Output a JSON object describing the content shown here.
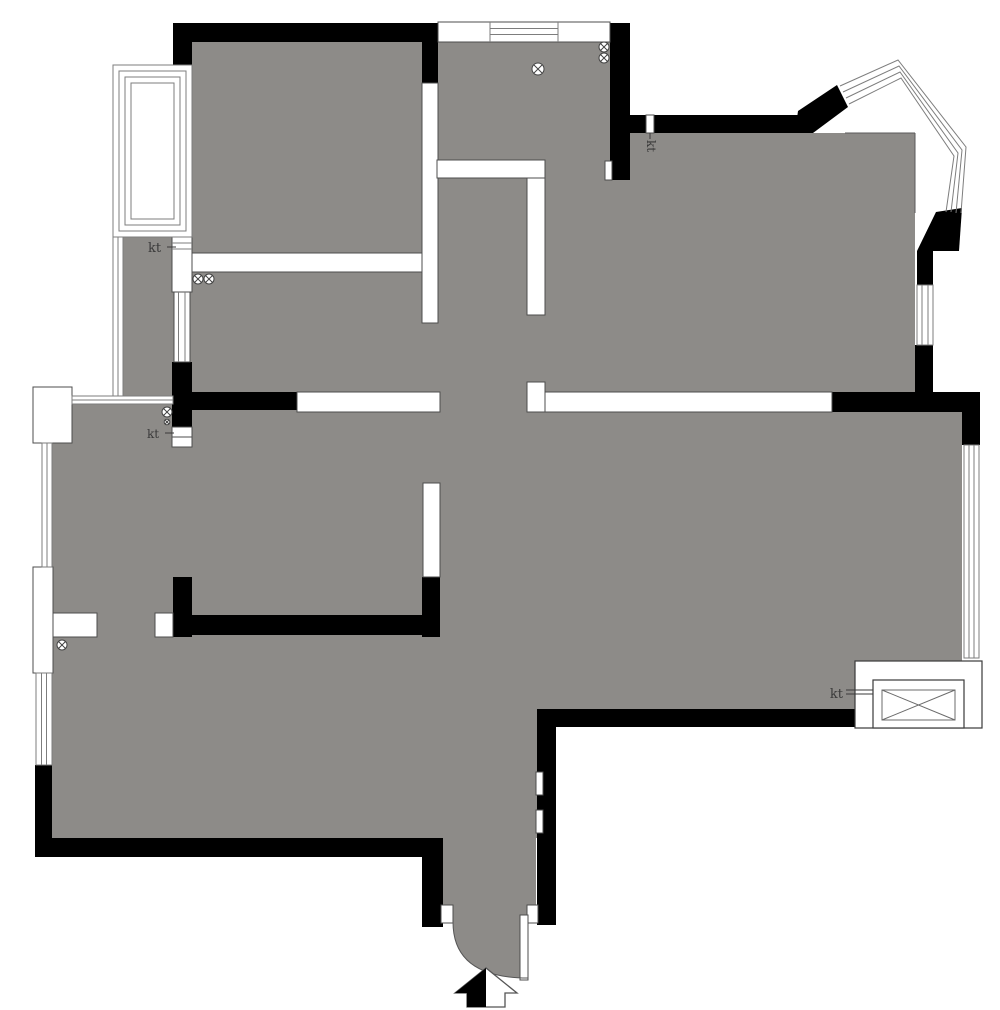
{
  "document": {
    "kind": "residential-floor-plan",
    "style": "black-and-white architectural drawing with gray floor fill"
  },
  "colors": {
    "background": "#ffffff",
    "floor": "#8d8b88",
    "wall_black": "#000000",
    "wall_white": "#ffffff",
    "outline": "#4d4d4d",
    "window_line": "#7d7d7d",
    "label": "#3a3a3a"
  },
  "labels": {
    "kt_kitchen": "kt",
    "kt_hall_door": "kt",
    "kt_balcony_vent": "kt",
    "kt_elevator": "kt"
  },
  "symbols": {
    "ceiling_fixture_glyph": "circle-x",
    "ceiling_fixture_count": 8
  },
  "features": {
    "elevator": "elevator-shaft-with-cross",
    "entrance_arrow": "entry-direction-arrow",
    "door_swing": "quarter-arc-door"
  }
}
